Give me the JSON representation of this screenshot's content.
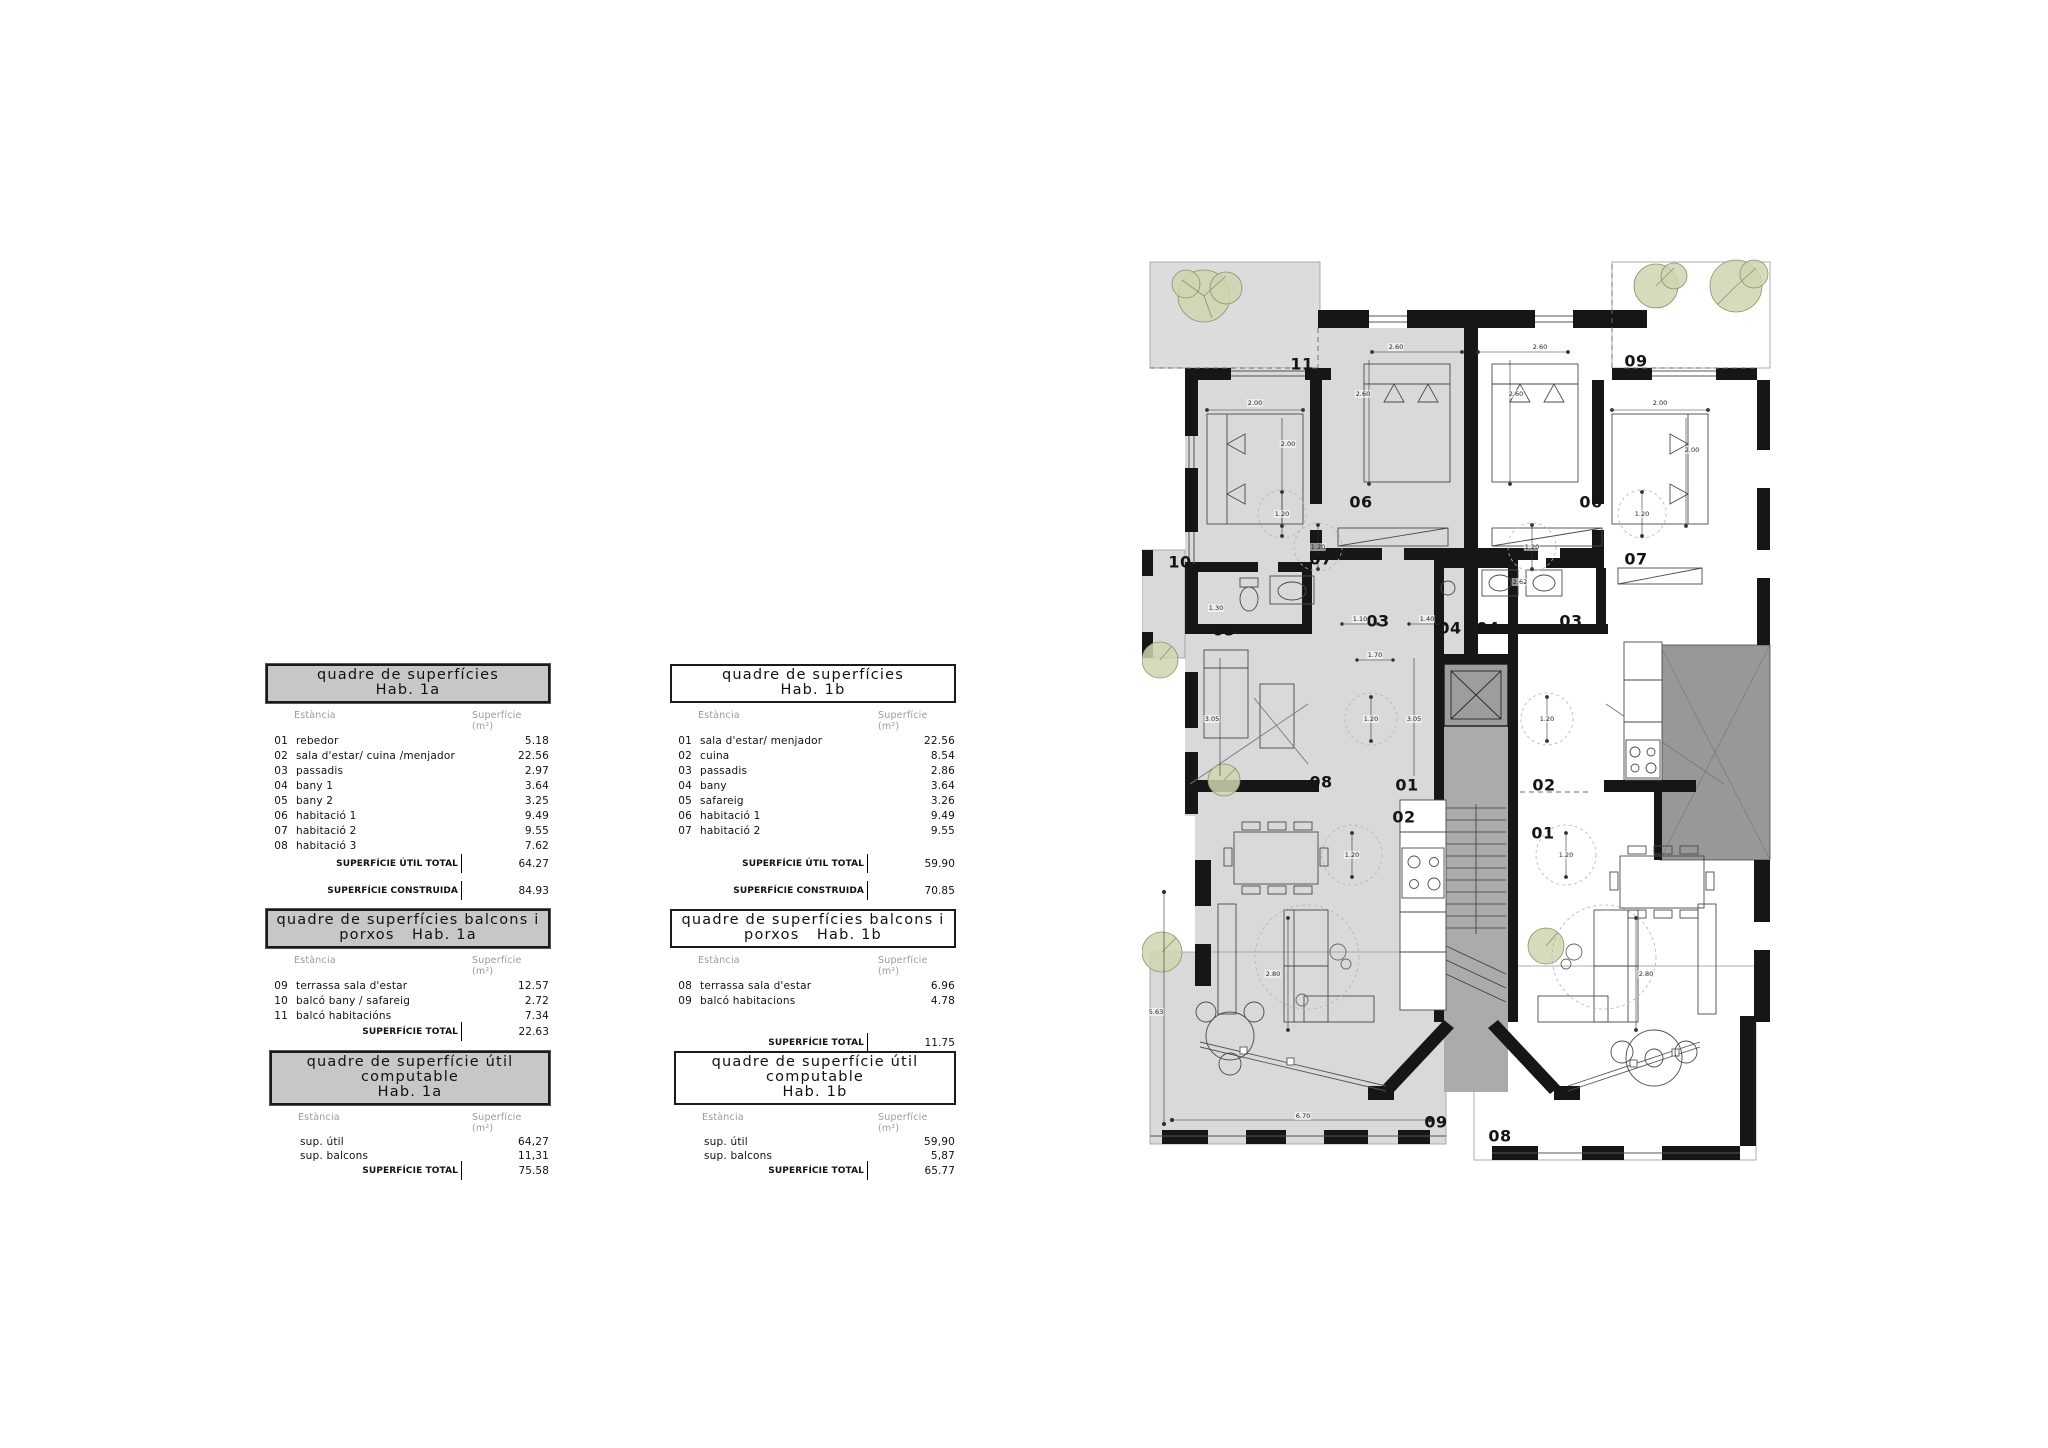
{
  "document": {
    "type": "architectural floor plan sheet",
    "background": "#ffffff"
  },
  "tables": [
    {
      "id": "superficies-1a",
      "shaded": true,
      "compact": false,
      "title_line1": "quadre de superfícies",
      "title_line2": "Hab. 1a",
      "col_room": "Estància",
      "col_area_line1": "Superfície",
      "col_area_line2": "(m²)",
      "rows": [
        [
          "01",
          "rebedor",
          "5.18"
        ],
        [
          "02",
          "sala d'estar/ cuina /menjador",
          "22.56"
        ],
        [
          "03",
          "passadis",
          "2.97"
        ],
        [
          "04",
          "bany 1",
          "3.64"
        ],
        [
          "05",
          "bany 2",
          "3.25"
        ],
        [
          "06",
          "habitació 1",
          "9.49"
        ],
        [
          "07",
          "habitació 2",
          "9.55"
        ],
        [
          "08",
          "habitació 3",
          "7.62"
        ]
      ],
      "totals": [
        {
          "label": "SUPERFÍCIE ÚTIL TOTAL",
          "value": "64.27",
          "mt": 3
        },
        {
          "label": "SUPERFÍCIE CONSTRUIDA",
          "value": "84.93",
          "mt": 13
        }
      ]
    },
    {
      "id": "superficies-1b",
      "shaded": false,
      "compact": false,
      "title_line1": "quadre de superfícies",
      "title_line2": "Hab. 1b",
      "col_room": "Estància",
      "col_area_line1": "Superfície",
      "col_area_line2": "(m²)",
      "rows": [
        [
          "01",
          "sala d'estar/ menjador",
          "22.56"
        ],
        [
          "02",
          "cuina",
          "8.54"
        ],
        [
          "03",
          "passadis",
          "2.86"
        ],
        [
          "04",
          "bany",
          "3.64"
        ],
        [
          "05",
          "safareig",
          "3.26"
        ],
        [
          "06",
          "habitació 1",
          "9.49"
        ],
        [
          "07",
          "habitació 2",
          "9.55"
        ]
      ],
      "totals": [
        {
          "label": "SUPERFÍCIE ÚTIL TOTAL",
          "value": "59.90",
          "mt": 18
        },
        {
          "label": "SUPERFÍCIE CONSTRUIDA",
          "value": "70.85",
          "mt": 13
        }
      ]
    },
    {
      "id": "balcons-1a",
      "shaded": true,
      "compact": false,
      "title_line1": "quadre de superfícies balcons i",
      "title_line2": "porxos   Hab. 1a",
      "col_room": "Estància",
      "col_area_line1": "Superfície",
      "col_area_line2": "(m²)",
      "rows": [
        [
          "09",
          "terrassa sala d'estar",
          "12.57"
        ],
        [
          "10",
          "balcó bany / safareig",
          "2.72"
        ],
        [
          "11",
          "balcó habitacións",
          "7.34"
        ]
      ],
      "totals": [
        {
          "label": "SUPERFÍCIE TOTAL",
          "value": "22.63",
          "mt": 1
        }
      ]
    },
    {
      "id": "balcons-1b",
      "shaded": false,
      "compact": false,
      "title_line1": "quadre de superfícies balcons i",
      "title_line2": "porxos   Hab. 1b",
      "col_room": "Estància",
      "col_area_line1": "Superfície",
      "col_area_line2": "(m²)",
      "rows": [
        [
          "08",
          "terrassa sala d'estar",
          "6.96"
        ],
        [
          "09",
          "balcó habitacions",
          "4.78"
        ]
      ],
      "totals": [
        {
          "label": "SUPERFÍCIE TOTAL",
          "value": "11.75",
          "mt": 27
        }
      ]
    },
    {
      "id": "util-computable-1a",
      "shaded": true,
      "compact": true,
      "title_line1": "quadre de superfície útil computable",
      "title_line2": "Hab. 1a",
      "col_room": "Estància",
      "col_area_line1": "Superfície",
      "col_area_line2": "(m²)",
      "rows": [
        [
          "",
          "sup. útil",
          "64,27"
        ],
        [
          "",
          "sup. balcons",
          "11,31"
        ]
      ],
      "totals": [
        {
          "label": "SUPERFÍCIE TOTAL",
          "value": "75.58",
          "mt": 1
        }
      ]
    },
    {
      "id": "util-computable-1b",
      "shaded": false,
      "compact": true,
      "title_line1": "quadre de superfície útil computable",
      "title_line2": "Hab. 1b",
      "col_room": "Estància",
      "col_area_line1": "Superfície",
      "col_area_line2": "(m²)",
      "rows": [
        [
          "",
          "sup. útil",
          "59,90"
        ],
        [
          "",
          "sup. balcons",
          "5,87"
        ]
      ],
      "totals": [
        {
          "label": "SUPERFÍCIE TOTAL",
          "value": "65.77",
          "mt": 1
        }
      ]
    }
  ],
  "floorplan": {
    "colors": {
      "apartment_fill": "#d9d9d9",
      "terrace_fill": "#dcdcdc",
      "core_fill": "#ababab",
      "elevator_fill": "#9d9d9d",
      "porch_fill": "#989898",
      "wall": "#161616",
      "tree_fill": "#ccd6b0",
      "tree_stroke": "#84956а"
    },
    "room_labels": [
      {
        "t": "11",
        "x": 160,
        "y": 112
      },
      {
        "t": "09",
        "x": 494,
        "y": 109
      },
      {
        "t": "06",
        "x": 219,
        "y": 250
      },
      {
        "t": "06",
        "x": 449,
        "y": 250
      },
      {
        "t": "07",
        "x": 179,
        "y": 307
      },
      {
        "t": "07",
        "x": 494,
        "y": 307
      },
      {
        "t": "10",
        "x": 38,
        "y": 310
      },
      {
        "t": "05",
        "x": 82,
        "y": 378
      },
      {
        "t": "03",
        "x": 236,
        "y": 369
      },
      {
        "t": "04",
        "x": 308,
        "y": 376
      },
      {
        "t": "04",
        "x": 346,
        "y": 376
      },
      {
        "t": "03",
        "x": 429,
        "y": 369
      },
      {
        "t": "08",
        "x": 179,
        "y": 530
      },
      {
        "t": "01",
        "x": 265,
        "y": 533
      },
      {
        "t": "02",
        "x": 262,
        "y": 565
      },
      {
        "t": "02",
        "x": 402,
        "y": 533
      },
      {
        "t": "01",
        "x": 401,
        "y": 581
      },
      {
        "t": "09",
        "x": 294,
        "y": 870
      },
      {
        "t": "08",
        "x": 358,
        "y": 884
      }
    ],
    "dimensions": [
      {
        "t": "2.60",
        "x": 254,
        "y": 95
      },
      {
        "t": "2.60",
        "x": 221,
        "y": 142
      },
      {
        "t": "2.60",
        "x": 398,
        "y": 95
      },
      {
        "t": "2.60",
        "x": 374,
        "y": 142
      },
      {
        "t": "2.00",
        "x": 113,
        "y": 151
      },
      {
        "t": "2.00",
        "x": 146,
        "y": 192
      },
      {
        "t": "2.00",
        "x": 518,
        "y": 151
      },
      {
        "t": "2.00",
        "x": 550,
        "y": 198
      },
      {
        "t": "1.20",
        "x": 140,
        "y": 262
      },
      {
        "t": "1.20",
        "x": 176,
        "y": 295
      },
      {
        "t": "1.20",
        "x": 390,
        "y": 295
      },
      {
        "t": "1.20",
        "x": 500,
        "y": 262
      },
      {
        "t": "1.20",
        "x": 229,
        "y": 467
      },
      {
        "t": "1.20",
        "x": 405,
        "y": 467
      },
      {
        "t": "1.20",
        "x": 210,
        "y": 603
      },
      {
        "t": "1.20",
        "x": 424,
        "y": 603
      },
      {
        "t": "1.30",
        "x": 74,
        "y": 356
      },
      {
        "t": "1.10",
        "x": 218,
        "y": 367
      },
      {
        "t": "1.40",
        "x": 285,
        "y": 367
      },
      {
        "t": "1.70",
        "x": 233,
        "y": 403
      },
      {
        "t": "3.05",
        "x": 70,
        "y": 467
      },
      {
        "t": "3.05",
        "x": 272,
        "y": 467
      },
      {
        "t": "2.62",
        "x": 378,
        "y": 330
      },
      {
        "t": "2.80",
        "x": 131,
        "y": 722
      },
      {
        "t": "2.80",
        "x": 504,
        "y": 722
      },
      {
        "t": "6.70",
        "x": 161,
        "y": 864
      },
      {
        "t": "5.63",
        "x": 14,
        "y": 760
      }
    ]
  }
}
